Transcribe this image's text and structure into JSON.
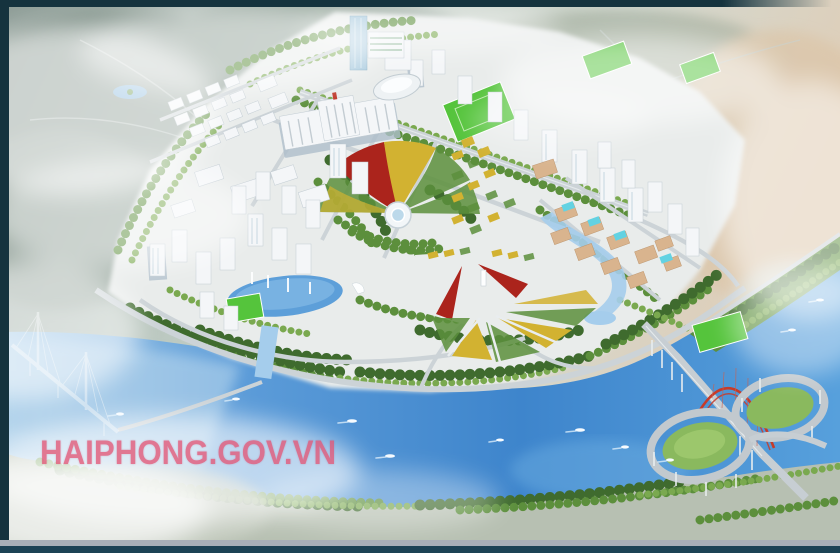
{
  "image": {
    "kind": "aerial-masterplan-rendering",
    "watermark": "HAIPHONG.GOV.VN"
  },
  "palette": {
    "frame": "#15333e",
    "frame_bottom": "#1c4355",
    "bottom_bar_gray": "#a9b0b8",
    "haze": "#c3cfc8",
    "haze_dark": "#83948c",
    "warm_tint": "#e2c3a3",
    "river": "#4f93d6",
    "river_deep": "#3478bf",
    "river_light": "#a5cdec",
    "tree_dark": "#3f6b2e",
    "tree_mid": "#5c8f3c",
    "tree_light": "#7aa94f",
    "field_green": "#55c43c",
    "ground": "#e9eceb",
    "road": "#ccd3d7",
    "building_white": "#f4f6f8",
    "building_shade": "#aebecb",
    "glass_blue": "#a5c8dd",
    "campus_tan": "#d9b48e",
    "campus_cyan": "#63d2e2",
    "flower_red": "#ab241c",
    "flower_yellow": "#d2b231",
    "arch_red": "#c63b2a",
    "watermark_pink": "#e25677"
  }
}
